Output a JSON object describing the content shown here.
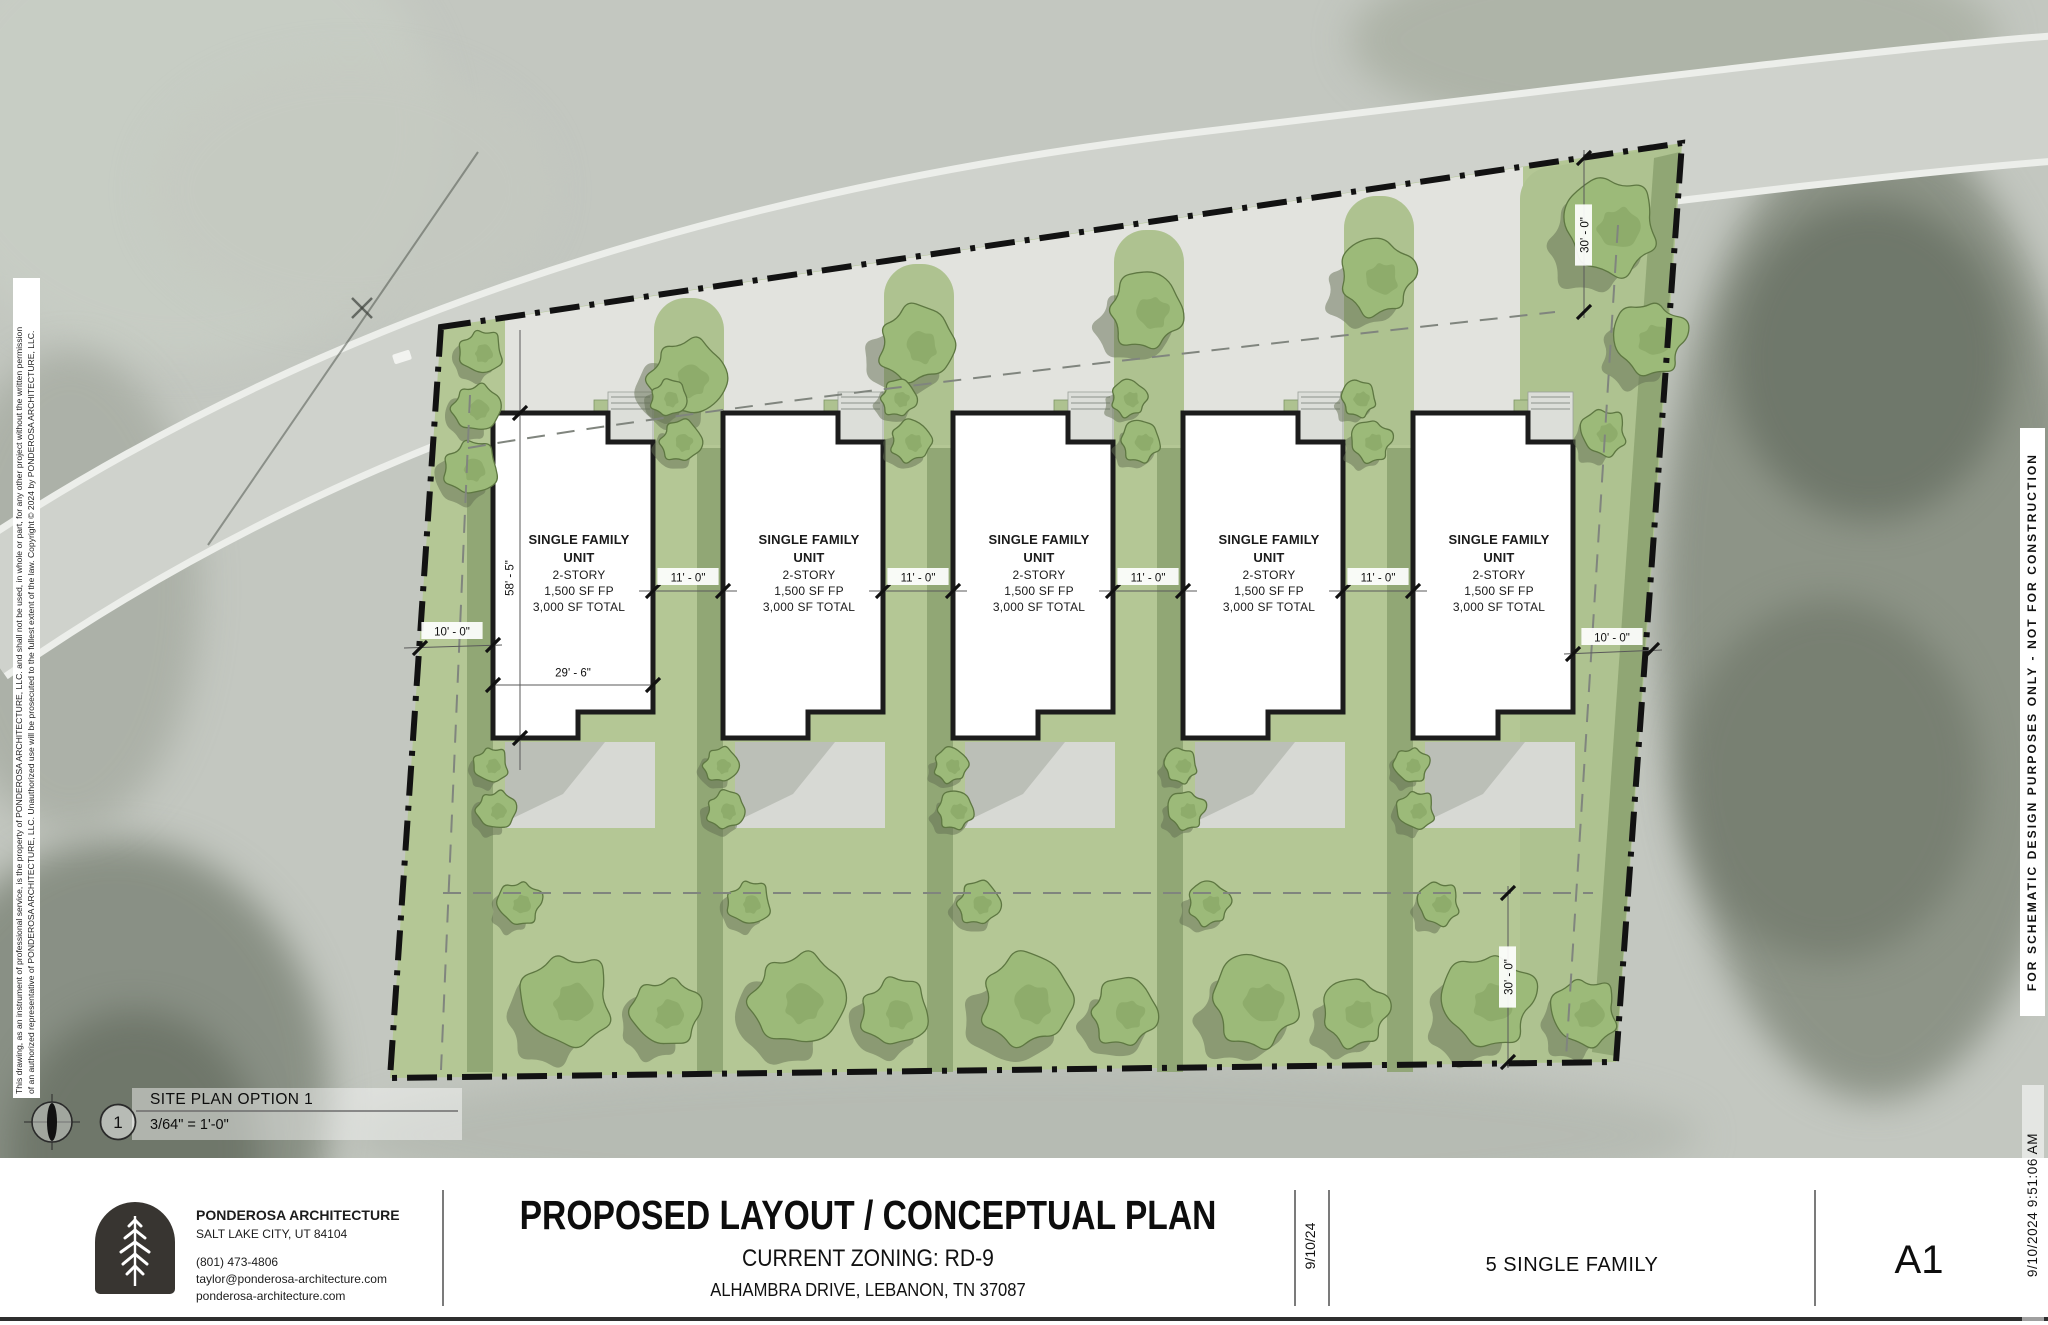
{
  "margins": {
    "left_copyright_line1": "This drawing, as an instrument of professional service, is the property of PONDEROSA ARCHITECTURE, LLC. and shall not be used, in whole or part, for any other project without the written permission",
    "left_copyright_line2": "of an authorized representative of PONDEROSA ARCHITECTURE, LLC. Unauthorized use will be prosecuted to the fullest extent of the law. Copyright © 2024 by PONDEROSA ARCHITECTURE, LLC.",
    "right_disclaimer": "FOR SCHEMATIC DESIGN PURPOSES ONLY - NOT FOR CONSTRUCTION",
    "right_timestamp": "9/10/2024 9:51:06 AM"
  },
  "plan": {
    "unit_count": 5,
    "unit_label": {
      "line1": "SINGLE FAMILY",
      "line2": "UNIT",
      "line3": "2-STORY",
      "line4": "1,500 SF FP",
      "line5": "3,000 SF TOTAL"
    },
    "dimensions": {
      "unit_depth": "58' - 5\"",
      "unit_width": "29' - 6\"",
      "unit_gap": "11' - 0\"",
      "side_setback": "10' - 0\"",
      "front_rear_setback": "30' - 0\""
    },
    "view_number": "1",
    "view_title": "SITE PLAN OPTION 1",
    "view_scale": "3/64\" = 1'-0\""
  },
  "title_block": {
    "firm_name": "PONDEROSA ARCHITECTURE",
    "firm_city": "SALT LAKE CITY, UT 84104",
    "firm_phone": "(801) 473-4806",
    "firm_email": "taylor@ponderosa-architecture.com",
    "firm_web": "ponderosa-architecture.com",
    "sheet_title": "PROPOSED LAYOUT / CONCEPTUAL PLAN",
    "zoning": "CURRENT ZONING: RD-9",
    "address": "ALHAMBRA DRIVE, LEBANON, TN 37087",
    "date": "9/10/24",
    "project": "5 SINGLE FAMILY",
    "sheet_number": "A1"
  },
  "colors": {
    "site_green": "#b4c795",
    "strip_green": "#aec290",
    "divider_green": "#8da371",
    "tree_fill": "#9cba79",
    "tree_stroke": "#5e7742",
    "front_gray": "#e2e3de",
    "patio_gray": "#d7d9d4",
    "road_gray": "#cfd2cc",
    "boundary_black": "#121212"
  }
}
